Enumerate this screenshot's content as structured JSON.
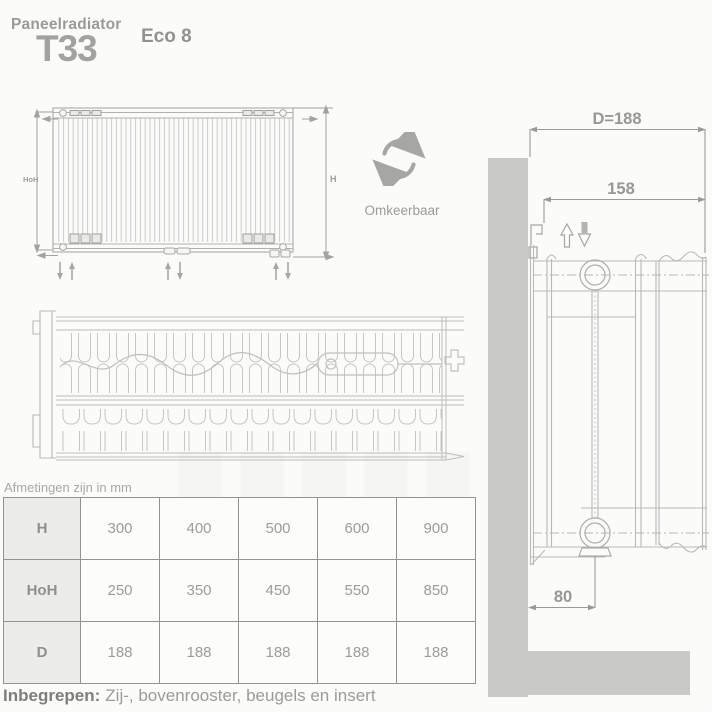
{
  "header": {
    "category": "Paneelradiator",
    "model": "T33",
    "series": "Eco 8"
  },
  "front_view": {
    "height_center_label": "HoH",
    "height_label": "H"
  },
  "reversible": {
    "label": "Omkeerbaar"
  },
  "side_view": {
    "depth_label": "D=188",
    "inner_width_label": "158",
    "wall_offset_label": "80"
  },
  "dimensions_table": {
    "caption": "Afmetingen zijn in mm",
    "rows": [
      {
        "label": "H",
        "values": [
          "300",
          "400",
          "500",
          "600",
          "900"
        ]
      },
      {
        "label": "HoH",
        "values": [
          "250",
          "350",
          "450",
          "550",
          "850"
        ]
      },
      {
        "label": "D",
        "values": [
          "188",
          "188",
          "188",
          "188",
          "188"
        ]
      }
    ]
  },
  "footer": {
    "label": "Inbegrepen:",
    "text": "Zij-, bovenrooster, beugels en insert"
  },
  "colors": {
    "wall": "#c9c9c8",
    "line": "#b9b9b8",
    "dim": "#9a9a99",
    "accent_text": "#9a9a99"
  }
}
